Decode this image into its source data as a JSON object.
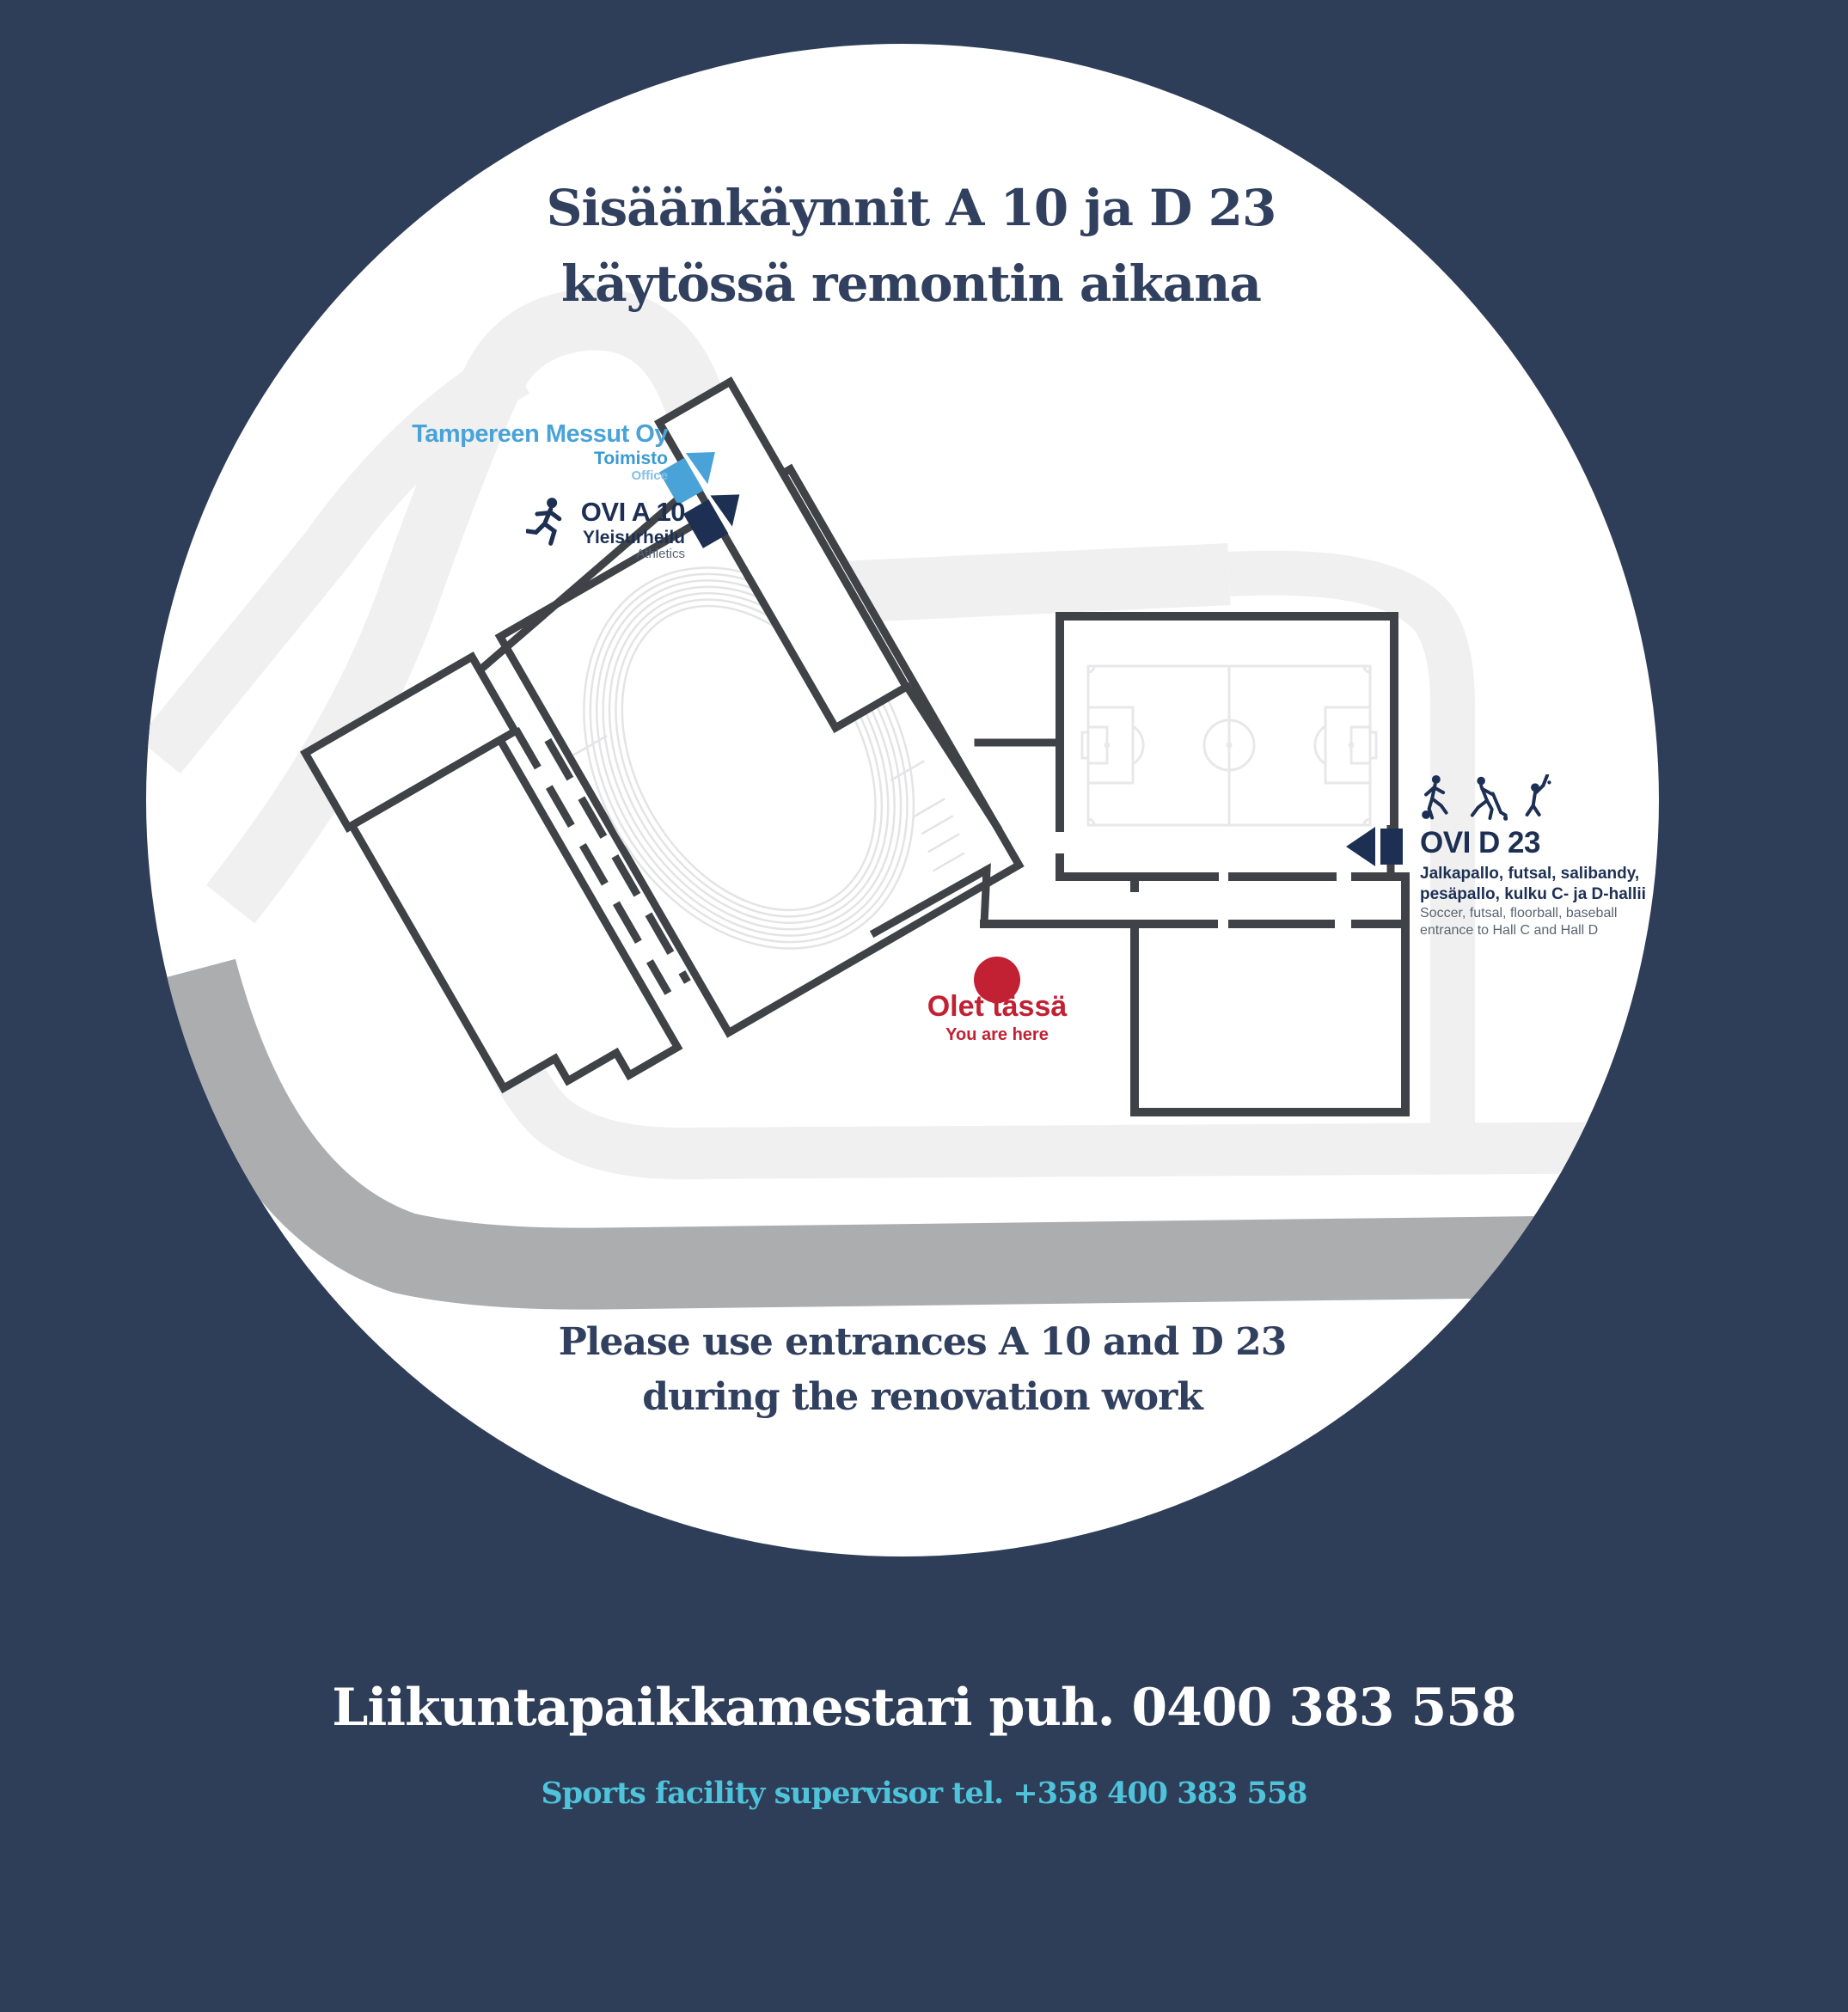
{
  "title": {
    "line1": "Sisäänkäynnit A 10 ja D 23",
    "line2": "käytössä remontin aikana"
  },
  "subtitle": {
    "line1": "Please use entrances A 10 and D 23",
    "line2": "during the renovation work"
  },
  "footer": {
    "fi": "Liikuntapaikkamestari puh. 0400 383 558",
    "en": "Sports facility supervisor tel. +358 400 383 558"
  },
  "map": {
    "office": {
      "company": "Tampereen Messut Oy",
      "label_fi": "Toimisto",
      "label_en": "Office"
    },
    "entrance_a10": {
      "name": "OVI A 10",
      "sport_fi": "Yleisurheilu",
      "sport_en": "Athletics"
    },
    "entrance_d23": {
      "name": "OVI D 23",
      "sports_fi_1": "Jalkapallo, futsal, salibandy,",
      "sports_fi_2": "pesäpallo, kulku C- ja D-hallii",
      "sports_en_1": "Soccer, futsal, floorball, baseball",
      "sports_en_2": "entrance to Hall C and Hall D"
    },
    "you_are_here": {
      "fi": "Olet tässä",
      "en": "You are here"
    },
    "icons": [
      "runner-icon",
      "soccer-player-icon",
      "floorball-player-icon",
      "baseball-batter-icon"
    ]
  },
  "colors": {
    "background": "#2e3d58",
    "title_navy": "#31405e",
    "label_navy": "#1d3054",
    "light_blue": "#49a3d8",
    "pale_blue": "#85bfe3",
    "cyan": "#4ec3da",
    "red": "#c22033",
    "road": "#f0f0f1",
    "band": "#abadaf",
    "wall": "#3f4347",
    "track": "#e4e4e6",
    "pitch": "#e8e8ea"
  }
}
